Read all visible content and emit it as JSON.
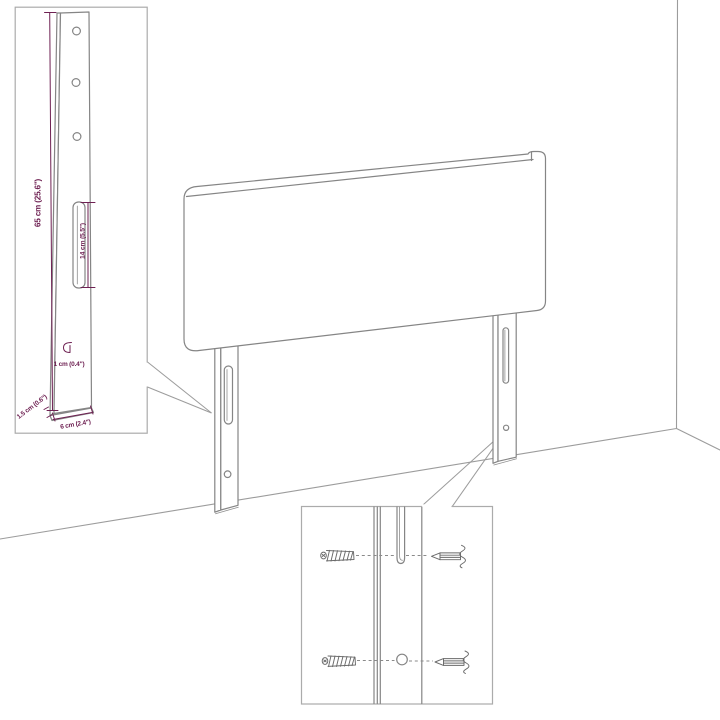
{
  "colors": {
    "background": "#ffffff",
    "furniture_outline": "#858585",
    "room_lines": "#9c9c9c",
    "inset_border": "#ababab",
    "dimension_accent": "#6e2052",
    "hardware": "#6a6a6a"
  },
  "dims": {
    "leg_height": "65 cm (25.6\")",
    "slot_length": "14 cm (5.5\")",
    "hole_offset": "1 cm (0.4\")",
    "leg_depth": "1.5 cm (0.6\")",
    "leg_width": "6 cm (2.4\")"
  }
}
